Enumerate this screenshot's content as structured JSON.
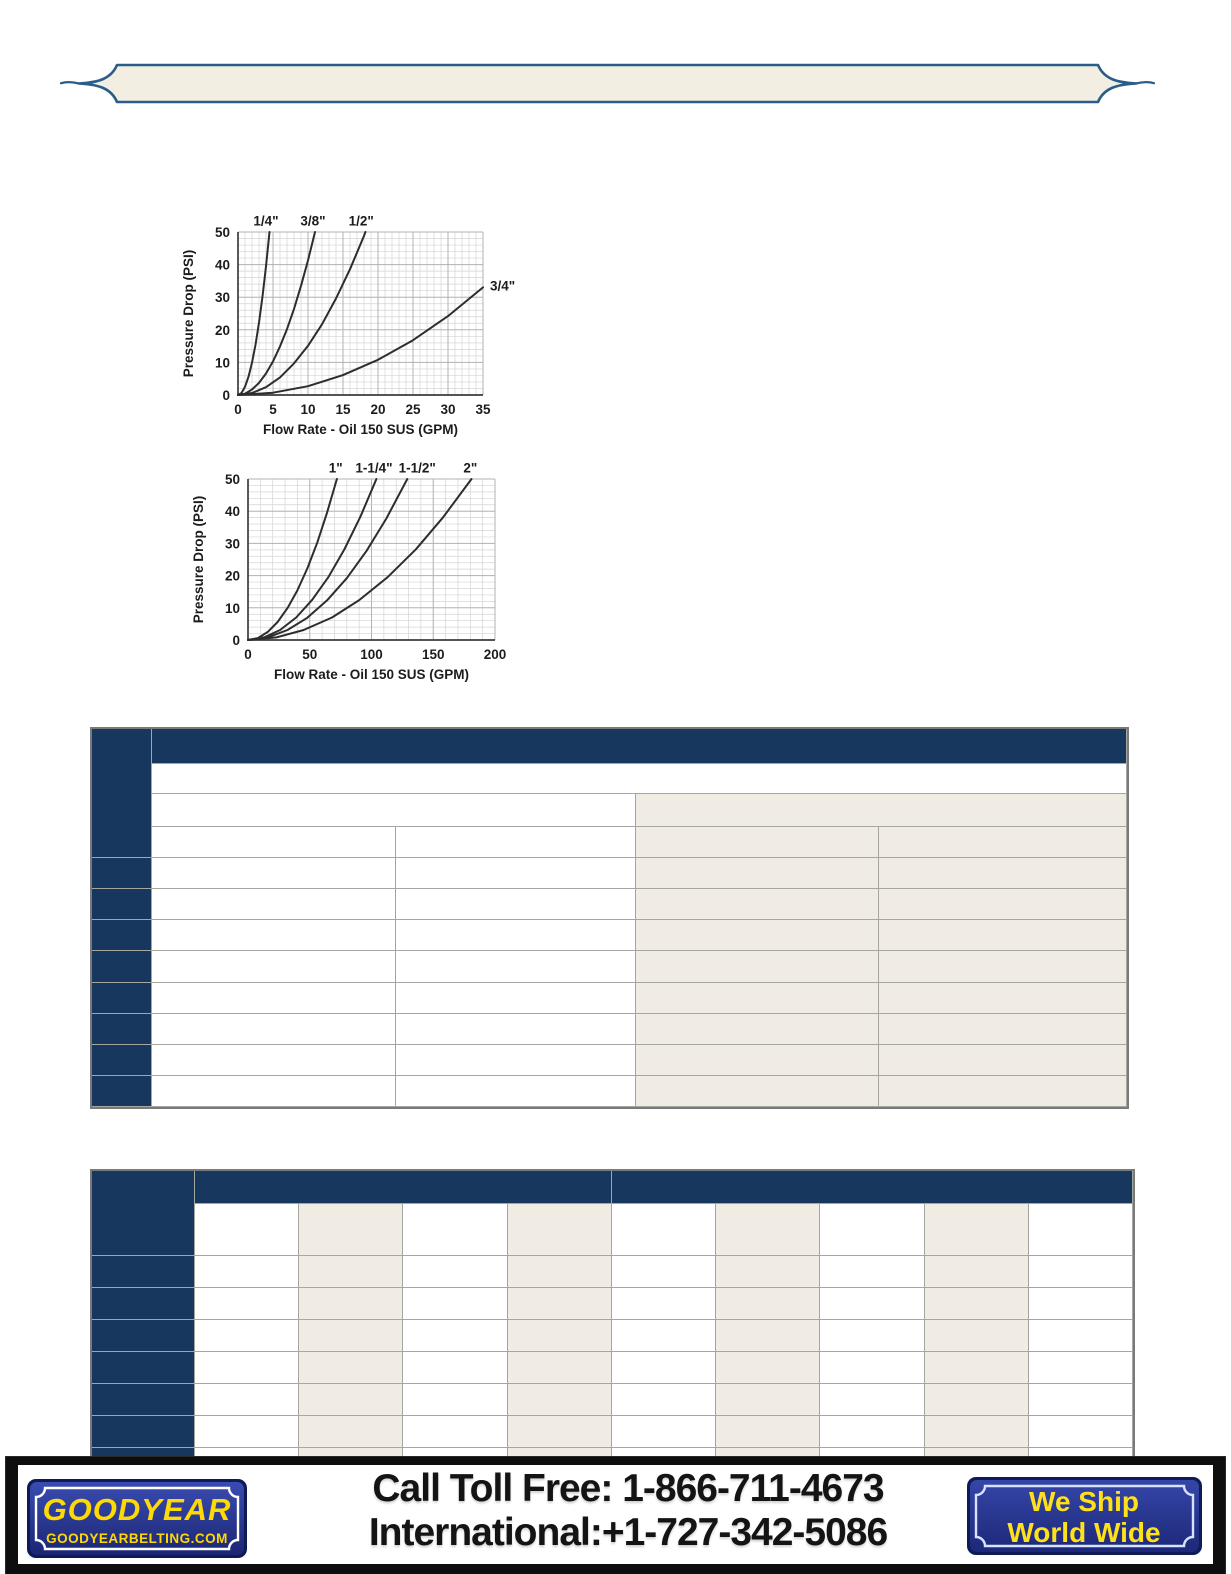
{
  "page": {
    "width": 1231,
    "height": 1574,
    "background": "#ffffff"
  },
  "banner": {
    "fill": "#f2eee2",
    "border_color": "#2a5c8a"
  },
  "colors": {
    "table_header_navy": "#17375e",
    "table_stripe_beige": "#f0ece3",
    "table_grid": "#a6a6a0",
    "table_border": "#7a7a7a",
    "curve_color": "#2d2d2d",
    "footer_black": "#0e0e0e",
    "badge_royal_blue": "#2c3b9e",
    "badge_dark_navy": "#0f1b57",
    "badge_yellow": "#ffd903"
  },
  "chart_data": [
    {
      "type": "line",
      "title": "",
      "xlabel": "Flow Rate - Oil 150 SUS (GPM)",
      "ylabel": "Pressure Drop (PSI)",
      "xlim": [
        0,
        35
      ],
      "ylim": [
        0,
        50
      ],
      "xticks": [
        0,
        5,
        10,
        15,
        20,
        25,
        30,
        35
      ],
      "yticks": [
        0,
        10,
        20,
        30,
        40,
        50
      ],
      "x_minor_step": 1,
      "y_minor_step": 2,
      "grid": true,
      "legend_position": "labels-on-curves",
      "series": [
        {
          "name": "1/4\"",
          "label_at": [
            4.0,
            52
          ],
          "label_anchor": "middle",
          "points": [
            [
              0,
              0
            ],
            [
              0.5,
              0.6
            ],
            [
              1,
              2.5
            ],
            [
              1.5,
              5.6
            ],
            [
              2,
              9.9
            ],
            [
              2.5,
              15.4
            ],
            [
              3,
              22.2
            ],
            [
              3.5,
              30.2
            ],
            [
              4,
              39.5
            ],
            [
              4.5,
              50
            ]
          ]
        },
        {
          "name": "3/8\"",
          "label_at": [
            10.7,
            52
          ],
          "label_anchor": "middle",
          "points": [
            [
              0,
              0
            ],
            [
              1,
              0.4
            ],
            [
              2,
              1.7
            ],
            [
              3,
              3.7
            ],
            [
              4,
              6.6
            ],
            [
              5,
              10.3
            ],
            [
              6,
              14.9
            ],
            [
              7,
              20.2
            ],
            [
              8,
              26.4
            ],
            [
              9,
              33.5
            ],
            [
              10,
              41.3
            ],
            [
              11,
              50
            ]
          ]
        },
        {
          "name": "1/2\"",
          "label_at": [
            17.6,
            52
          ],
          "label_anchor": "middle",
          "points": [
            [
              0,
              0
            ],
            [
              2,
              0.6
            ],
            [
              4,
              2.4
            ],
            [
              6,
              5.4
            ],
            [
              8,
              9.7
            ],
            [
              10,
              15.1
            ],
            [
              12,
              21.7
            ],
            [
              14,
              29.6
            ],
            [
              16,
              38.6
            ],
            [
              18,
              48.8
            ],
            [
              18.2,
              50
            ]
          ]
        },
        {
          "name": "3/4\"",
          "label_at": [
            36.0,
            32
          ],
          "label_anchor": "start",
          "points": [
            [
              0,
              0
            ],
            [
              5,
              0.7
            ],
            [
              10,
              2.7
            ],
            [
              15,
              6.1
            ],
            [
              20,
              10.8
            ],
            [
              25,
              16.8
            ],
            [
              30,
              24.2
            ],
            [
              35,
              33
            ]
          ]
        }
      ]
    },
    {
      "type": "line",
      "title": "",
      "xlabel": "Flow Rate - Oil 150 SUS (GPM)",
      "ylabel": "Pressure Drop (PSI)",
      "xlim": [
        0,
        200
      ],
      "ylim": [
        0,
        50
      ],
      "xticks": [
        0,
        50,
        100,
        150,
        200
      ],
      "yticks": [
        0,
        10,
        20,
        30,
        40,
        50
      ],
      "x_minor_step": 10,
      "y_minor_step": 2,
      "grid": true,
      "legend_position": "labels-on-curves",
      "series": [
        {
          "name": "1\"",
          "label_at": [
            71,
            52
          ],
          "label_anchor": "middle",
          "points": [
            [
              0,
              0
            ],
            [
              8,
              0.6
            ],
            [
              16,
              2.5
            ],
            [
              24,
              5.6
            ],
            [
              32,
              9.9
            ],
            [
              40,
              15.4
            ],
            [
              48,
              22.2
            ],
            [
              56,
              30.2
            ],
            [
              64,
              39.5
            ],
            [
              72,
              50
            ]
          ]
        },
        {
          "name": "1-1/4\"",
          "label_at": [
            102,
            52
          ],
          "label_anchor": "middle",
          "points": [
            [
              0,
              0
            ],
            [
              13,
              0.8
            ],
            [
              26,
              3.1
            ],
            [
              39,
              7.0
            ],
            [
              52,
              12.5
            ],
            [
              65,
              19.5
            ],
            [
              78,
              28.1
            ],
            [
              91,
              38.3
            ],
            [
              104,
              50
            ]
          ]
        },
        {
          "name": "1-1/2\"",
          "label_at": [
            137,
            52
          ],
          "label_anchor": "middle",
          "points": [
            [
              0,
              0
            ],
            [
              16,
              0.8
            ],
            [
              32,
              3.1
            ],
            [
              48,
              6.9
            ],
            [
              64,
              12.3
            ],
            [
              80,
              19.2
            ],
            [
              96,
              27.7
            ],
            [
              112,
              37.7
            ],
            [
              129,
              50
            ]
          ]
        },
        {
          "name": "2\"",
          "label_at": [
            180,
            52
          ],
          "label_anchor": "middle",
          "points": [
            [
              0,
              0
            ],
            [
              23,
              0.8
            ],
            [
              45,
              3.1
            ],
            [
              68,
              7.0
            ],
            [
              90,
              12.4
            ],
            [
              113,
              19.5
            ],
            [
              136,
              28.2
            ],
            [
              158,
              38.1
            ],
            [
              181,
              50
            ]
          ]
        }
      ]
    }
  ],
  "footer": {
    "goodyear": {
      "brand": "GOODYEAR",
      "website": "GOODYEARBELTING.COM"
    },
    "phone_lines": [
      "Call Toll Free: 1-866-711-4673",
      "International:+1-727-342-5086"
    ],
    "ship_badge": {
      "line1": "We Ship",
      "line2": "World Wide"
    }
  }
}
